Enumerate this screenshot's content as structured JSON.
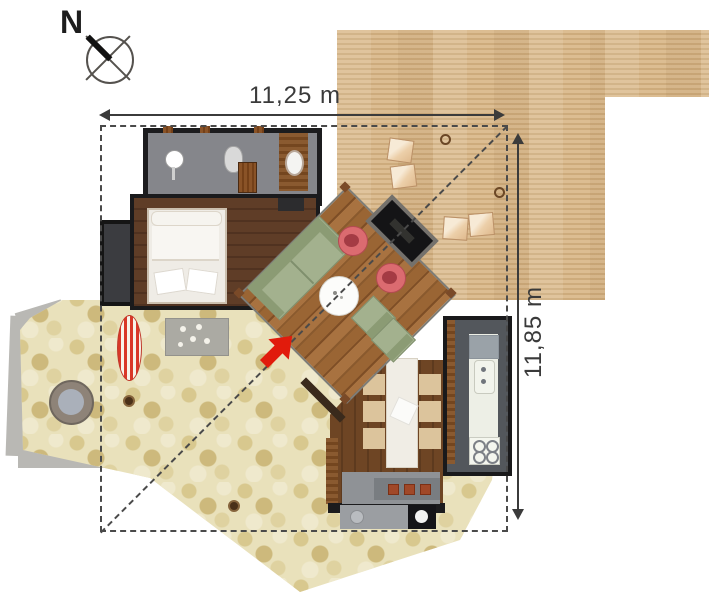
{
  "annotations": {
    "width_label": "11,25 m",
    "height_label": "11,85 m"
  },
  "compass": {
    "label": "N"
  },
  "colors": {
    "accent_arrow": "#e11b0c",
    "deck_wood": "#d5b285",
    "interior_wood_dark": "#5f3d27",
    "interior_wood_mid": "#9a6534",
    "stone_patio": "#e9e1bb",
    "concrete": "#b9b8b4",
    "walls": "#1b1b1d",
    "sofa_green": "#a3b18e",
    "chair_pink": "#db6b70",
    "dimension_lines": "#3b3b3b"
  }
}
